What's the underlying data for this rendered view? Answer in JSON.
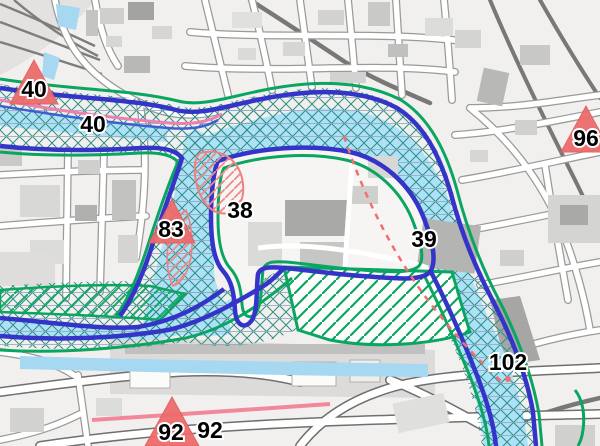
{
  "map": {
    "view_name": "flood-hazard-map-view",
    "markers": [
      {
        "id": "marker-40",
        "label": "40"
      },
      {
        "id": "marker-83",
        "label": "83"
      },
      {
        "id": "marker-96",
        "label": "96"
      },
      {
        "id": "marker-92",
        "label": "92"
      }
    ],
    "labels": [
      {
        "id": "label-40",
        "text": "40"
      },
      {
        "id": "label-38",
        "text": "38"
      },
      {
        "id": "label-39",
        "text": "39"
      },
      {
        "id": "label-102",
        "text": "102"
      },
      {
        "id": "label-92",
        "text": "92"
      }
    ],
    "colors": {
      "flood_water_fill": "#ade1f8",
      "flood_boundary_blue": "#3434c9",
      "extent_boundary_green": "#0ba562",
      "hazard_outline_red": "#ef8080",
      "hazard_dash_red": "#f07070",
      "marker_red": "#ed6c6c",
      "centerline_pink": "#ee7fae",
      "base_water_blue": "#a6d8f2",
      "red_road": "#f2899b",
      "crosshatch_teal": "#2f8e82"
    }
  }
}
